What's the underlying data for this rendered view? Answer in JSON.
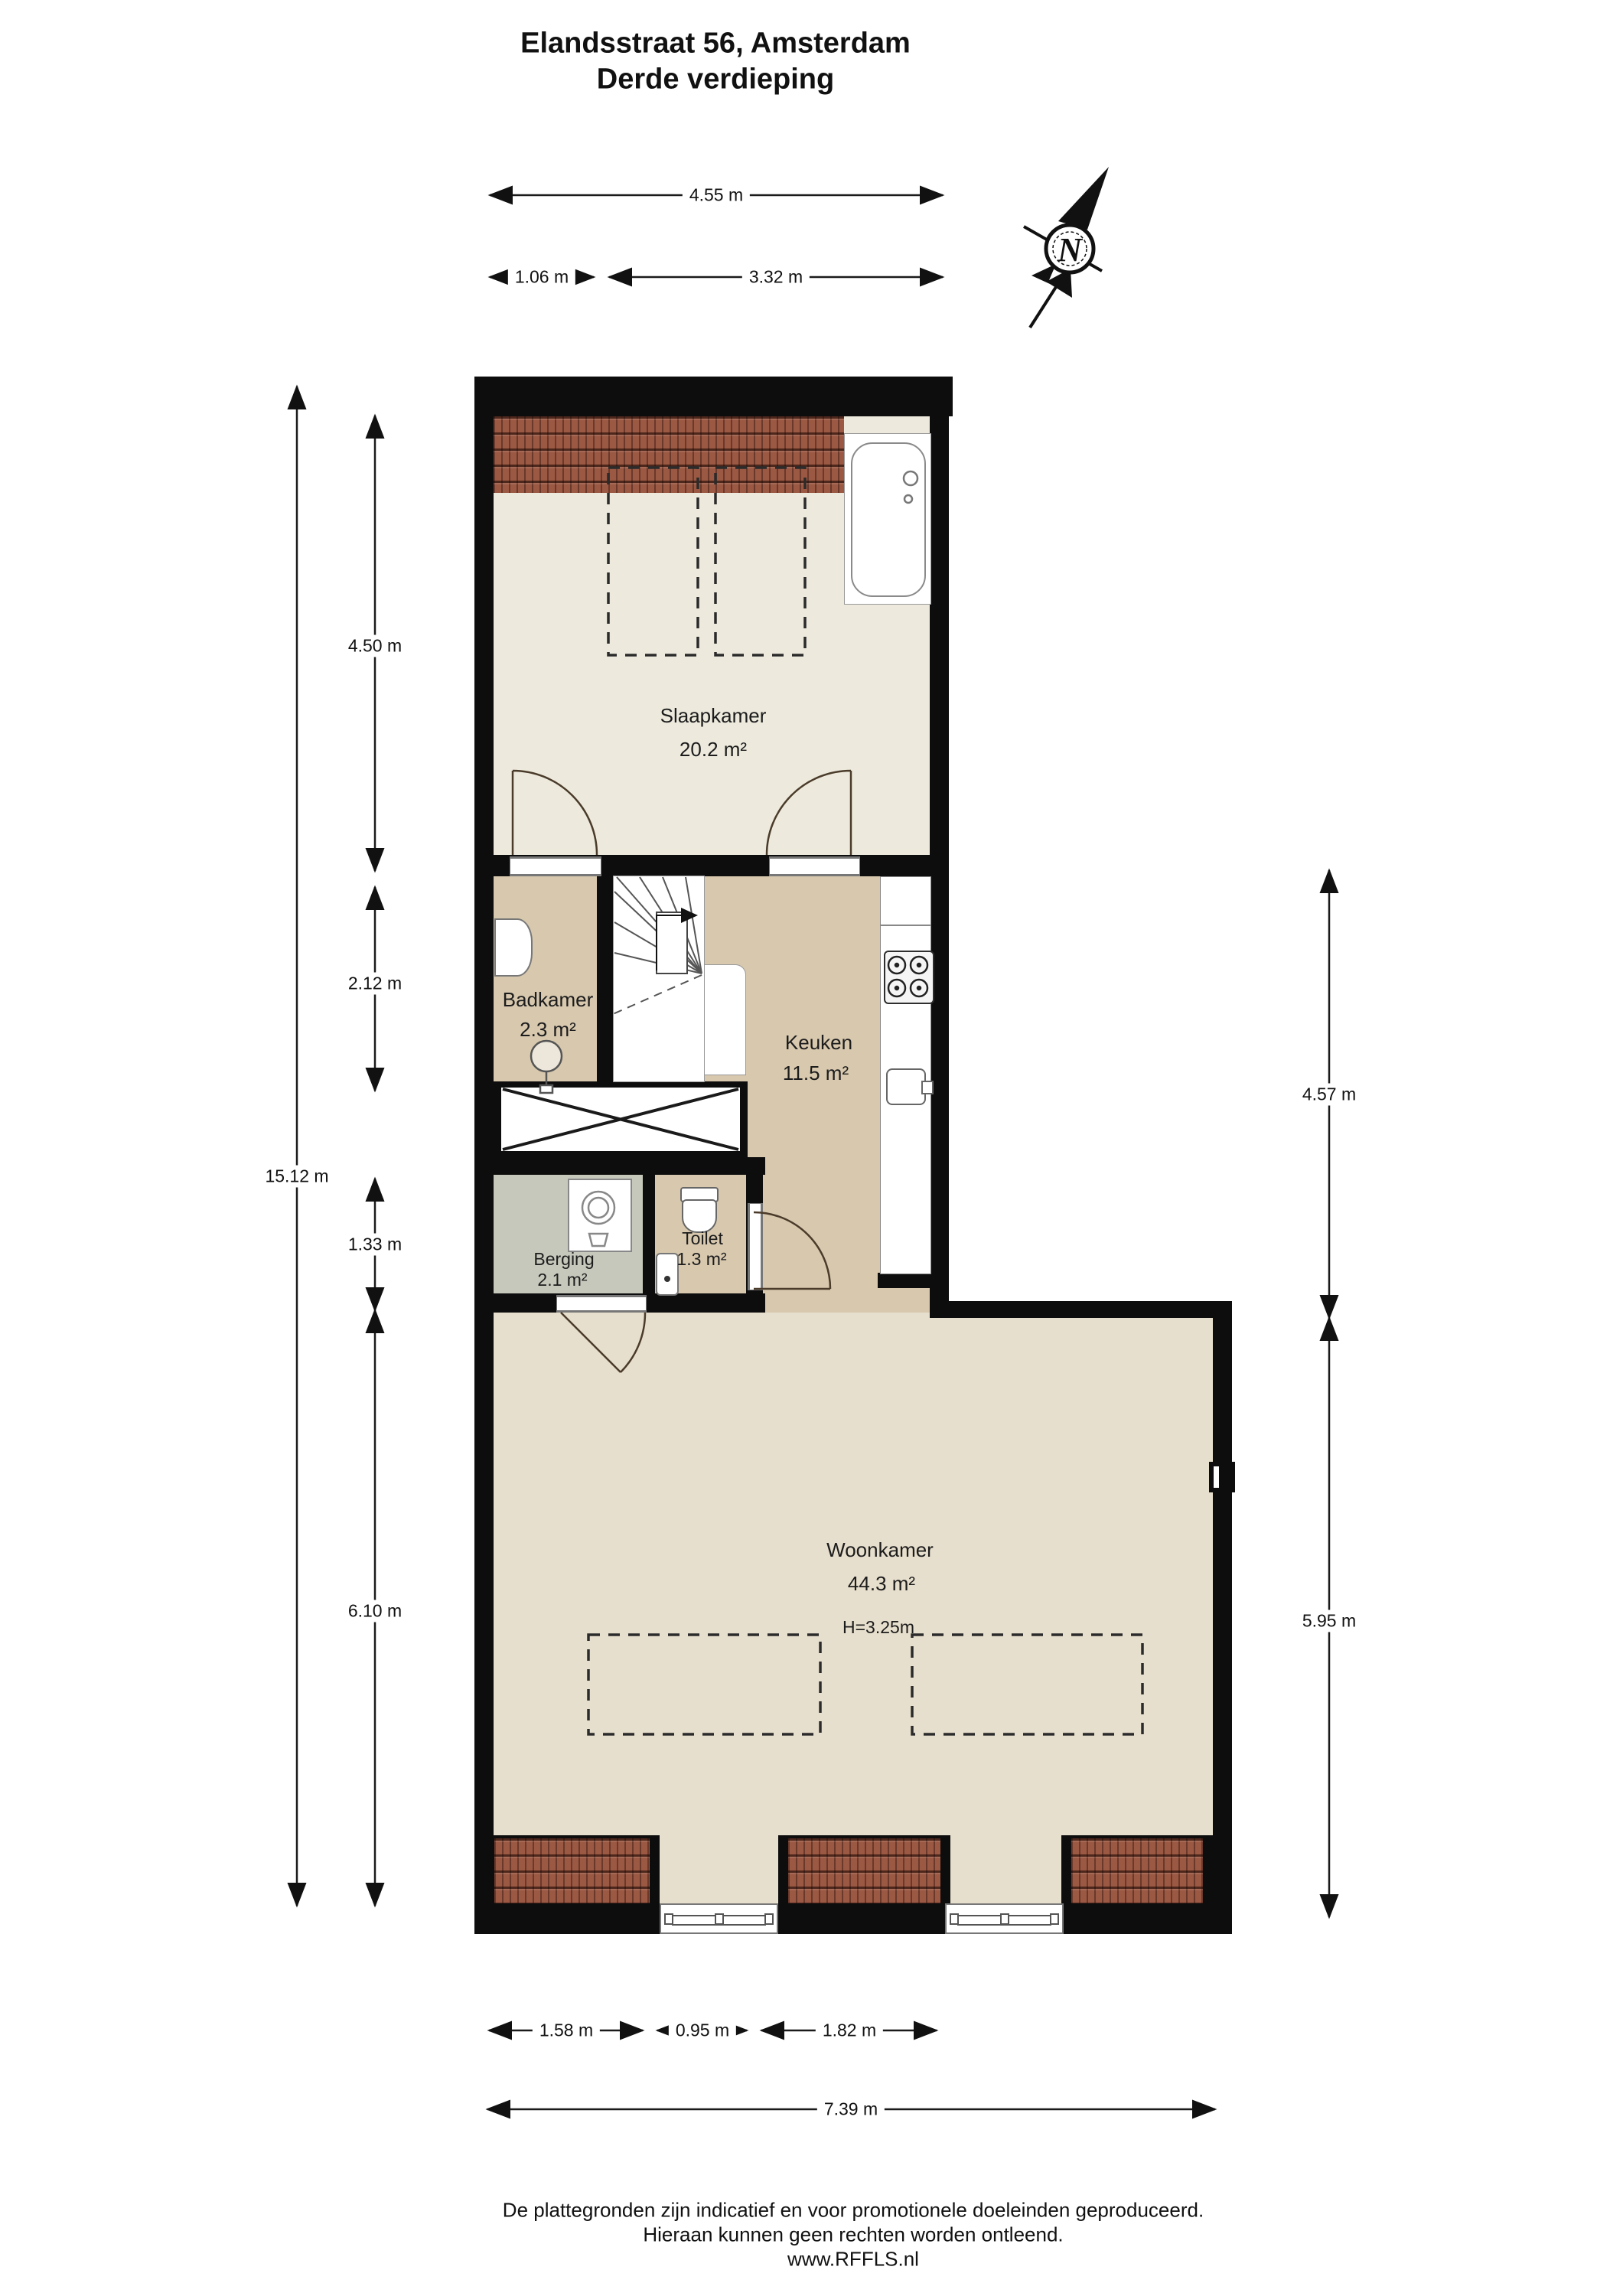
{
  "title": {
    "line1": "Elandsstraat 56, Amsterdam",
    "line2": "Derde verdieping"
  },
  "compass": {
    "label": "N"
  },
  "rooms": [
    {
      "id": "slaapkamer",
      "name": "Slaapkamer",
      "area": "20.2 m²"
    },
    {
      "id": "badkamer",
      "name": "Badkamer",
      "area": "2.3 m²"
    },
    {
      "id": "keuken",
      "name": "Keuken",
      "area": "11.5 m²"
    },
    {
      "id": "berging",
      "name": "Berging",
      "area": "2.1 m²"
    },
    {
      "id": "toilet",
      "name": "Toilet",
      "area": "1.3 m²"
    },
    {
      "id": "woonkamer",
      "name": "Woonkamer",
      "area": "44.3 m²",
      "ceiling_height": "H=3.25m"
    }
  ],
  "dimensions": {
    "top_total": "4.55 m",
    "top_segments": [
      "1.06 m",
      "3.32 m"
    ],
    "left_total": "15.12 m",
    "left_segments": [
      "4.50 m",
      "2.12 m",
      "1.33 m",
      "6.10 m"
    ],
    "right_segments": [
      "4.57 m",
      "5.95 m"
    ],
    "bottom_segments": [
      "1.58 m",
      "0.95 m",
      "1.82 m"
    ],
    "bottom_total": "7.39 m"
  },
  "footer": {
    "line1": "De plattegronden zijn indicatief en voor promotionele doeleinden geproduceerd.",
    "line2": "Hieraan kunnen geen rechten worden ontleend.",
    "line3": "www.RFFLS.nl"
  },
  "colors": {
    "wall": "#0d0d0d",
    "floor_bedroom": "#edeadd",
    "floor_hall": "#d7c8ae",
    "floor_storage": "#c6c8bc",
    "floor_living": "#e7dfcd",
    "roof_tile": "#9b5843"
  }
}
